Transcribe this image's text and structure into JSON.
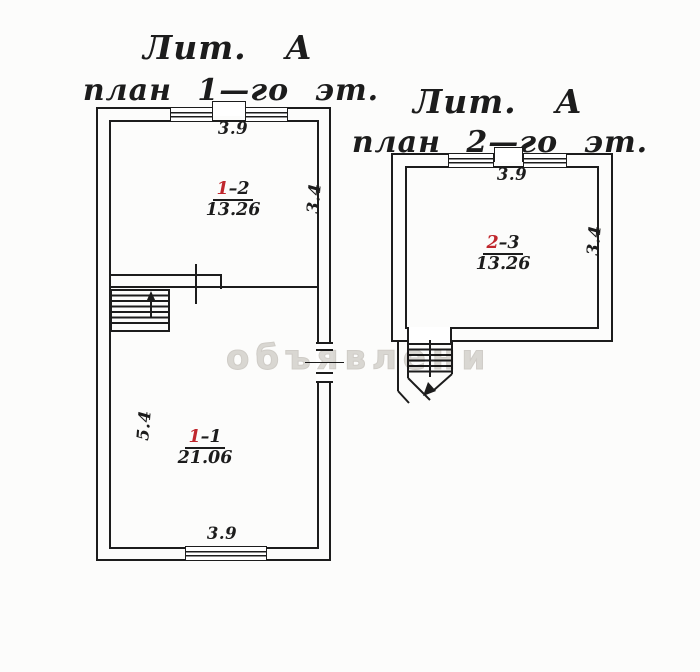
{
  "watermark_text": "объявлени",
  "colors": {
    "ink": "#1c1c1c",
    "red_ink": "#c0272d",
    "watermark": "#dcdad6"
  },
  "floor1": {
    "title_liter": "Лит. А",
    "title_plan": "план 1—го эт.",
    "dim_top": "3.9",
    "dim_bottom": "3.9",
    "dim_left": "5.4",
    "dim_right": "3.4",
    "room_upper": {
      "floor_digit": "1",
      "rest": "–2",
      "area": "13.26"
    },
    "room_lower": {
      "floor_digit": "1",
      "rest": "–1",
      "area": "21.06"
    }
  },
  "floor2": {
    "title_liter": "Лит. А",
    "title_plan": "план 2—го эт.",
    "dim_top": "3.9",
    "dim_right": "3.4",
    "room": {
      "floor_digit": "2",
      "rest": "–3",
      "area": "13.26"
    }
  }
}
